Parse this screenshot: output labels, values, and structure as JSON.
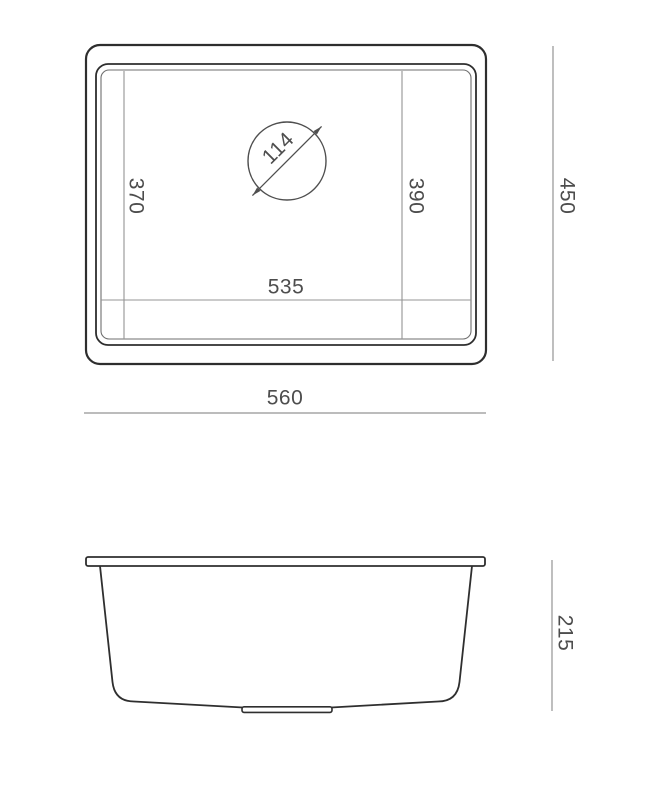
{
  "drawing": {
    "type": "technical-dimension-drawing",
    "subject": "undermount-sink",
    "views": {
      "top": {
        "labels": {
          "bowl_width": "535",
          "overall_width": "560",
          "overall_depth": "450",
          "left_inner_depth": "370",
          "right_inner_depth": "390",
          "drain_diameter": "114"
        }
      },
      "side": {
        "labels": {
          "height": "215"
        }
      }
    },
    "colors": {
      "outline_dark": "#2e2e2e",
      "line_medium": "#4f4f4f",
      "line_light": "#949494",
      "text": "#4d4d4d",
      "background": "#ffffff"
    }
  }
}
